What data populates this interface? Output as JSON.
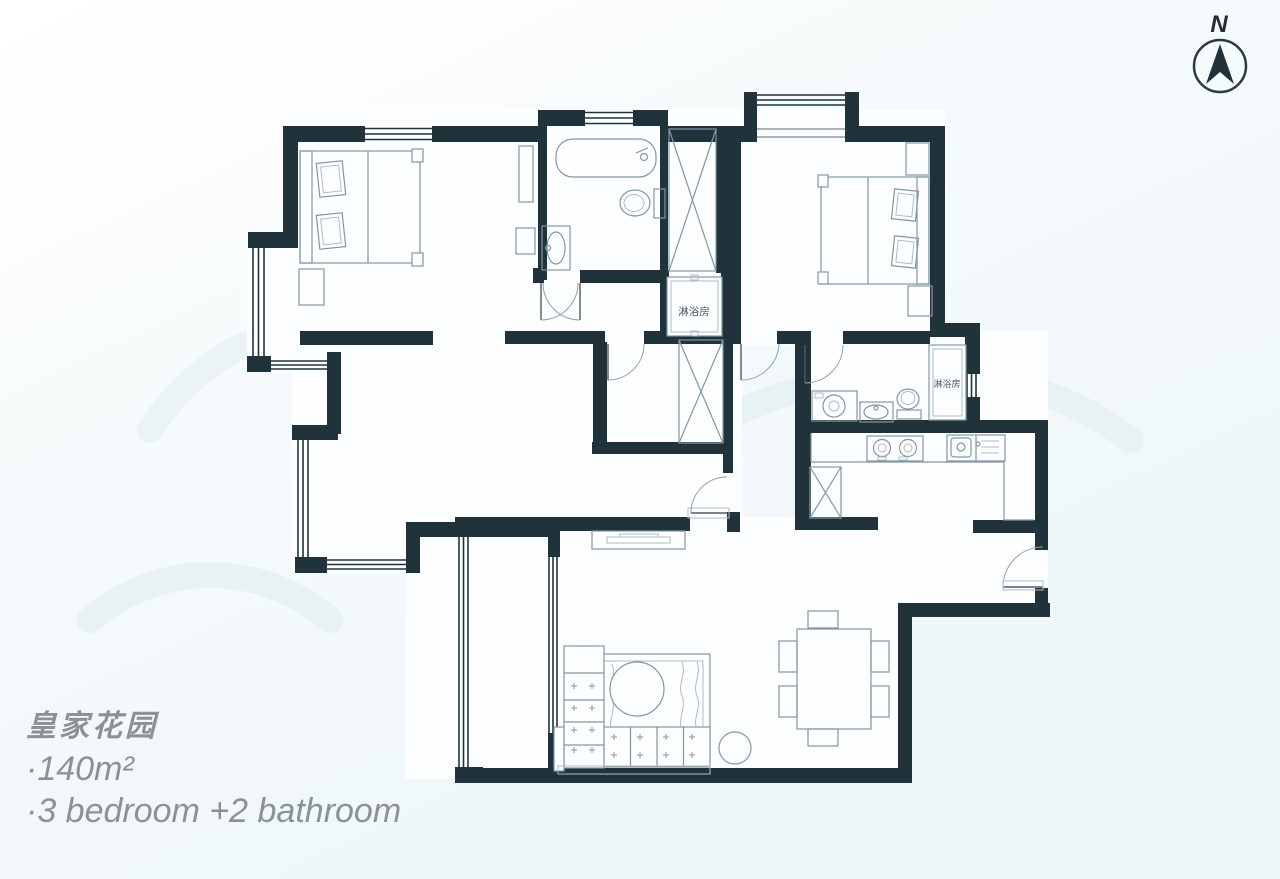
{
  "title": {
    "name": "皇家花园",
    "area": "·140m²",
    "rooms": "·3 bedroom +2 bathroom"
  },
  "compass": {
    "label": "N"
  },
  "labels": {
    "shower_room_1": "淋浴房",
    "shower_room_2": "淋浴房"
  },
  "colors": {
    "wall": "#20333b",
    "furniture": "#8296a2",
    "bg": "#f4f9fa",
    "text-gray": "#8b9197",
    "label": "#46565f"
  }
}
